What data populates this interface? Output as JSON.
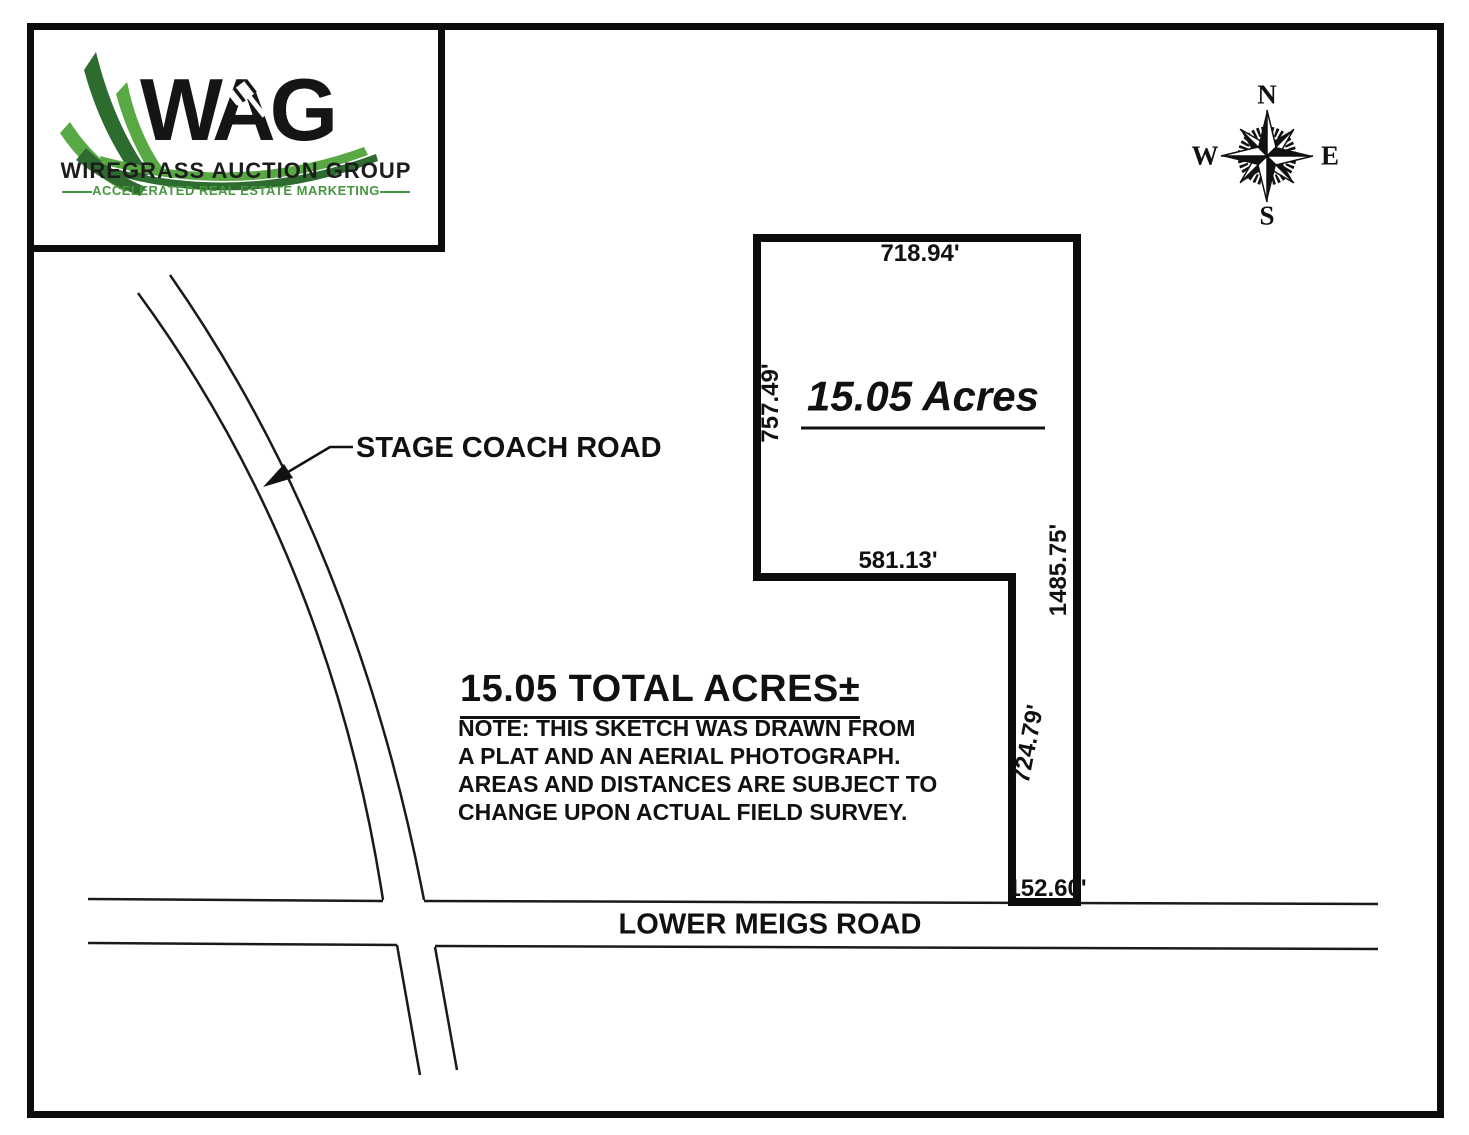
{
  "logo": {
    "acronym": "WAG",
    "name": "WIREGRASS AUCTION GROUP",
    "tagline": "ACCELERATED REAL ESTATE MARKETING",
    "colors": {
      "dark_green": "#2e6b2f",
      "light_green": "#58a844",
      "text_green": "#47973f",
      "black": "#151515"
    }
  },
  "compass": {
    "north": "N",
    "east": "E",
    "south": "S",
    "west": "W"
  },
  "parcel": {
    "acres_label": "15.05 Acres",
    "dimensions": [
      {
        "side": "top",
        "label": "718.94'"
      },
      {
        "side": "left",
        "label": "757.49'"
      },
      {
        "side": "right",
        "label": "1485.75'"
      },
      {
        "side": "step",
        "label": "581.13'"
      },
      {
        "side": "inner",
        "label": "724.79'"
      },
      {
        "side": "bottom",
        "label": "152.60'"
      }
    ]
  },
  "roads": {
    "stage_coach": {
      "name": "STAGE COACH ROAD"
    },
    "lower_meigs": {
      "name": "LOWER MEIGS ROAD"
    }
  },
  "summary": {
    "heading": "15.05 TOTAL ACRES±",
    "note": "NOTE: THIS SKETCH WAS DRAWN FROM\nA PLAT AND AN AERIAL PHOTOGRAPH.\nAREAS AND DISTANCES ARE SUBJECT TO\nCHANGE UPON ACTUAL FIELD SURVEY."
  }
}
